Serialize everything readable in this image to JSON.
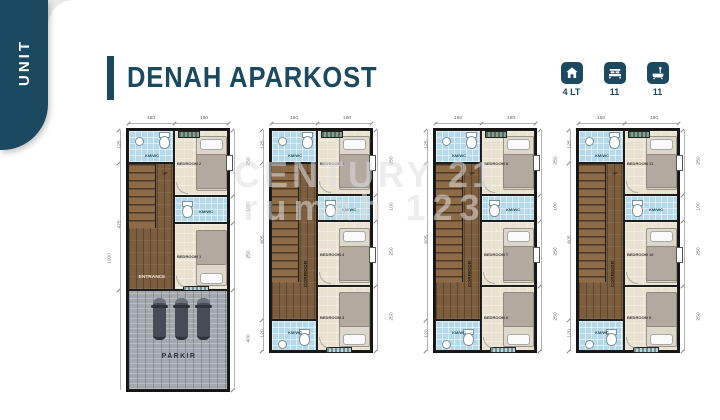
{
  "colors": {
    "accent": "#1b4960",
    "bath_floor": "#b5d9e9",
    "bedroom_floor": "#eae2d0",
    "wood_floor": "#7c5d3e",
    "paving": "#a2a8ad"
  },
  "sidebar": {
    "label": "UNIT"
  },
  "header": {
    "title": "DENAH APARKOST"
  },
  "stats": [
    {
      "icon": "house-icon",
      "label": "4 LT"
    },
    {
      "icon": "bed-icon",
      "label": "11"
    },
    {
      "icon": "bath-icon",
      "label": "11"
    }
  ],
  "watermark": {
    "line1": "CENTURY 21",
    "line2": "rumah 123"
  },
  "plans": [
    {
      "type": "ground",
      "top_dims": [
        "160",
        "190"
      ],
      "left_dims": [
        "125",
        "475"
      ],
      "overall_dim": "1000",
      "right_dims": [
        "250",
        "100",
        "250",
        "400"
      ],
      "rooms": {
        "bath_top": "KM/WC",
        "bed_top": "BEDROOM 2",
        "bath_mid": "KM/WC",
        "bed_bottom": "BEDROOM 1",
        "hall": "ENTRANCE",
        "stairs": "UP",
        "parking": "PARKIR"
      }
    },
    {
      "type": "upper",
      "top_dims": [
        "160",
        "190"
      ],
      "left_dims": [
        "125",
        "605",
        "120"
      ],
      "right_dims": [
        "250",
        "100",
        "250",
        "250"
      ],
      "rooms": {
        "bath_top": "KM/WC",
        "bed_top": "BEDROOM 5",
        "bath_mid": "KM/WC",
        "bed_mid": "BEDROOM 4",
        "bed_bottom": "BEDROOM 3",
        "bath_bottom": "KM/WC",
        "corridor": "CORRIDOR",
        "stairs": "UP"
      }
    },
    {
      "type": "upper",
      "top_dims": [
        "160",
        "190"
      ],
      "left_dims": [
        "125",
        "605",
        "120"
      ],
      "right_dims": [
        "250",
        "100",
        "250",
        "250"
      ],
      "rooms": {
        "bath_top": "KM/WC",
        "bed_top": "BEDROOM 8",
        "bath_mid": "KM/WC",
        "bed_mid": "BEDROOM 7",
        "bed_bottom": "BEDROOM 6",
        "bath_bottom": "KM/WC",
        "corridor": "CORRIDOR",
        "stairs": "UP"
      }
    },
    {
      "type": "upper",
      "top_dims": [
        "160",
        "190"
      ],
      "left_dims": [
        "125",
        "605",
        "120"
      ],
      "right_dims": [
        "250",
        "100",
        "250",
        "250"
      ],
      "rooms": {
        "bath_top": "KM/WC",
        "bed_top": "BEDROOM 11",
        "bath_mid": "KM/WC",
        "bed_mid": "BEDROOM 10",
        "bed_bottom": "BEDROOM 9",
        "bath_bottom": "KM/WC",
        "corridor": "CORRIDOR",
        "stairs": "UP"
      }
    }
  ]
}
